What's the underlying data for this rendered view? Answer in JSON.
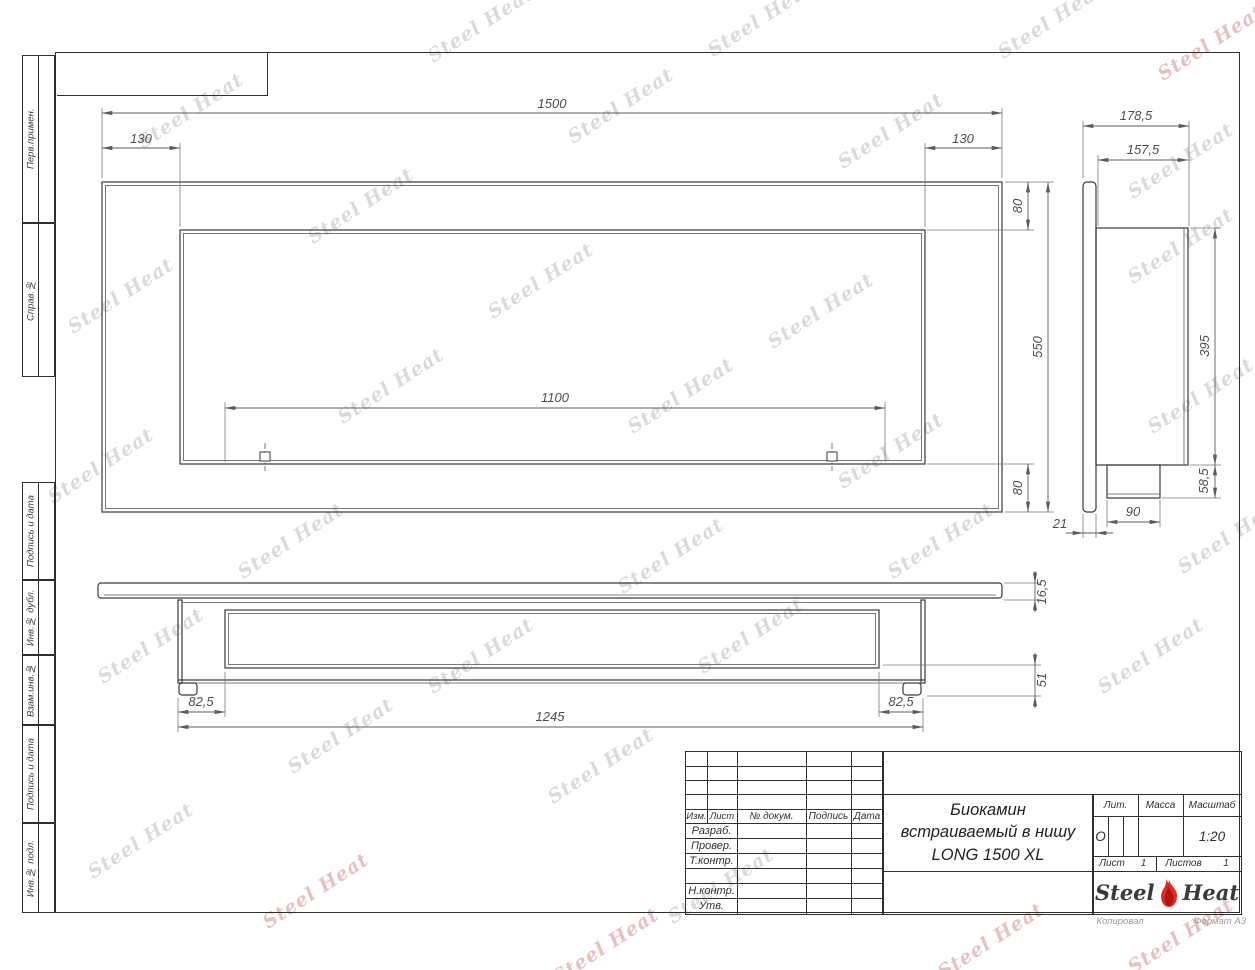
{
  "watermark": {
    "text": "Steel Heat"
  },
  "margins": [
    "Перв.примен.",
    "Справ.№",
    "Подпись и дата",
    "Инв.№ дубл.",
    "Взам.инв.№",
    "Подпись и дата",
    "Инв.№ подл."
  ],
  "dims": {
    "w1500": "1500",
    "off_l": "130",
    "off_r": "130",
    "h80t": "80",
    "h550": "550",
    "h80b": "80",
    "w1100": "1100",
    "d178": "178,5",
    "d157": "157,5",
    "h395": "395",
    "h58": "58,5",
    "t21": "21",
    "w90": "90",
    "t16": "16,5",
    "h51": "51",
    "o82l": "82,5",
    "w1245": "1245",
    "o82r": "82,5"
  },
  "title_block": {
    "header_cols": [
      "Изм.",
      "Лист",
      "№ докум.",
      "Подпись",
      "Дата"
    ],
    "row_razrab": "Разраб.",
    "row_prover": "Провер.",
    "row_tkontr": "Т.контр.",
    "row_nkontr": "Н.контр.",
    "row_utv": "Утв.",
    "name_line1": "Биокамин",
    "name_line2": "встраиваемый в нишу",
    "name_line3": "LONG 1500 XL",
    "lit_label": "Лит.",
    "mass_label": "Масса",
    "scale_label": "Масштаб",
    "lit_value": "О",
    "scale_value": "1:20",
    "sheet_label": "Лист",
    "sheet_value": "1",
    "sheets_label": "Листов",
    "sheets_value": "1",
    "logo_steel": "Steel",
    "logo_heat": "Heat"
  },
  "footer": {
    "copied": "Копировал",
    "format": "Формат А3"
  }
}
